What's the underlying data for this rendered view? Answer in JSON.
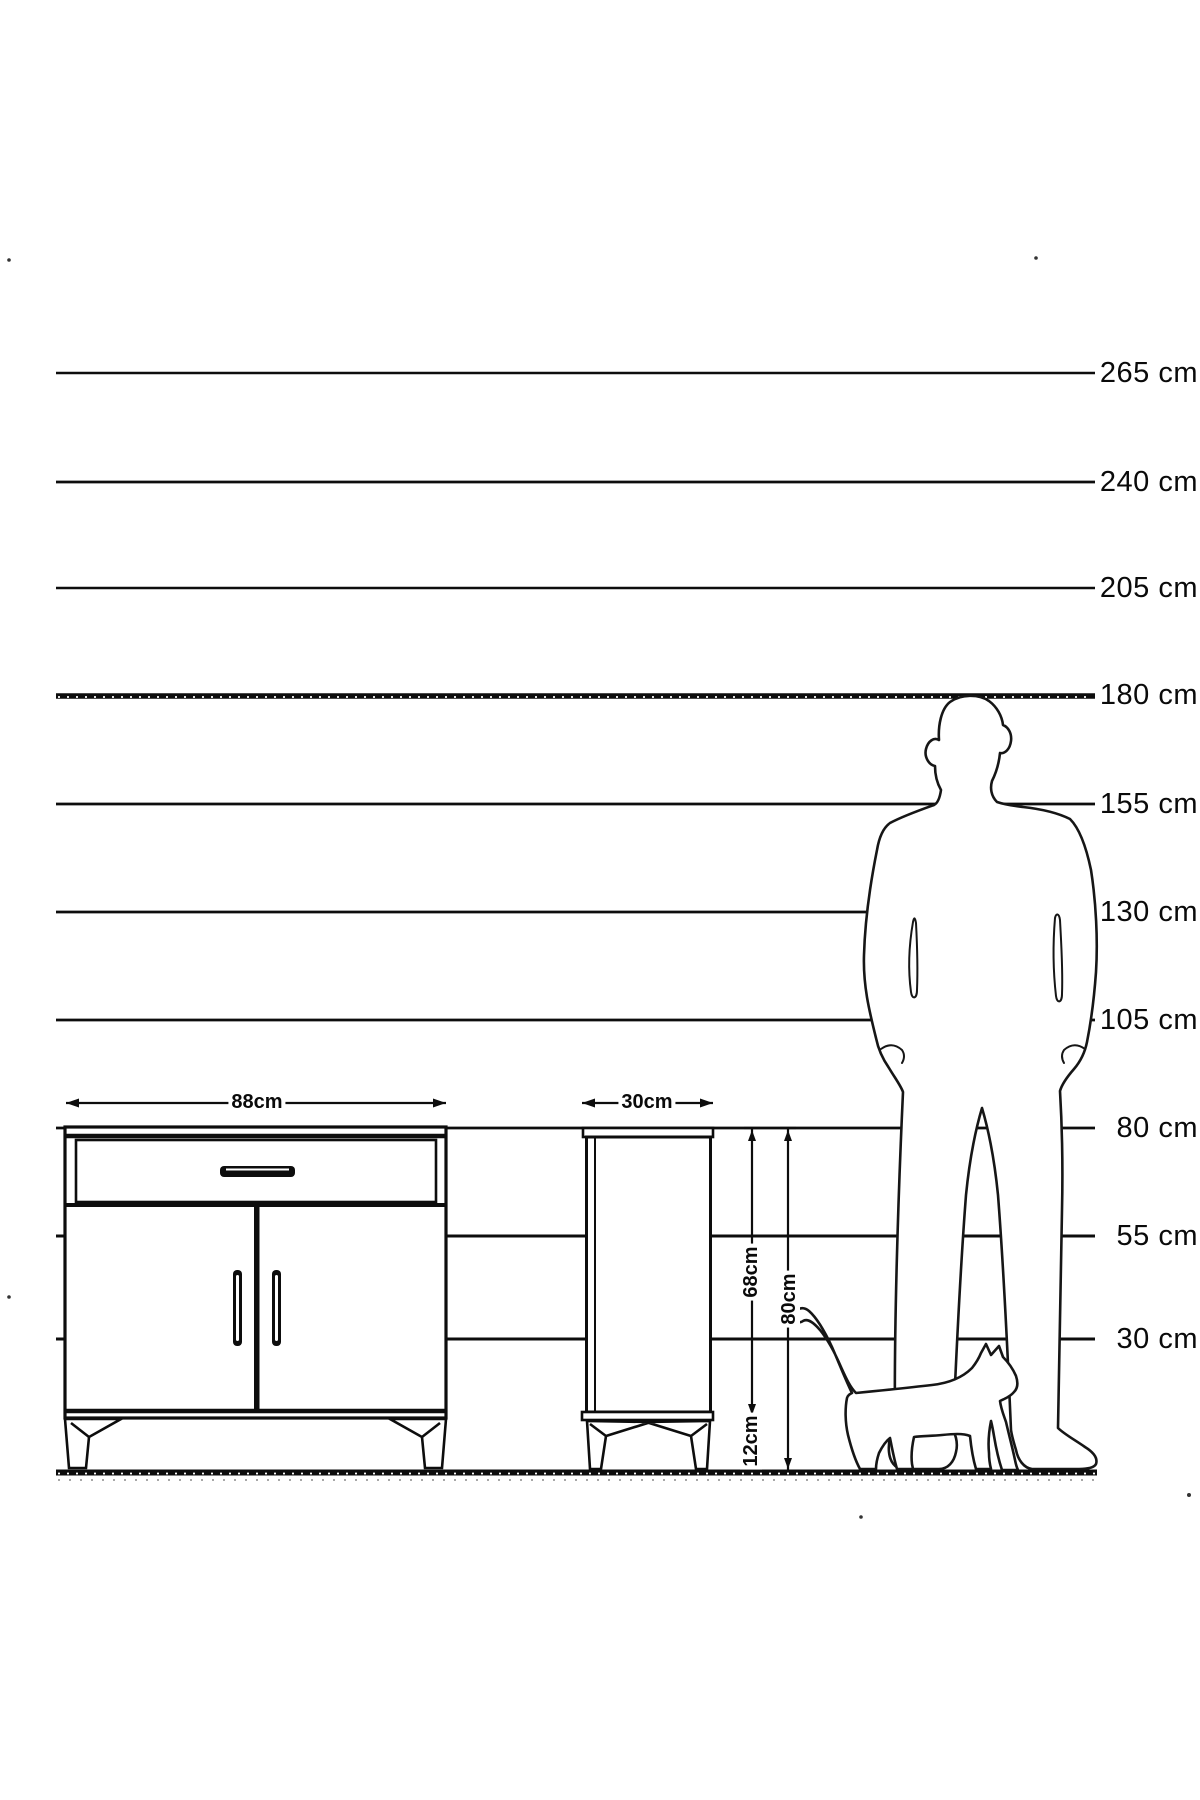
{
  "page": {
    "type": "furniture dimension diagram",
    "background_color": "#ffffff",
    "ink_color": "#0d0d0d",
    "unit": "cm"
  },
  "height_scale": {
    "unit": "cm",
    "labels": [
      "265 cm",
      "240 cm",
      "205 cm",
      "180 cm",
      "155 cm",
      "130 cm",
      "105 cm",
      "80 cm",
      "55 cm",
      "30 cm"
    ]
  },
  "dimensions": {
    "sideboard_width": "88cm",
    "cabinet_depth": "30cm",
    "carcass_height": "68cm",
    "overall_height": "80cm",
    "leg_height": "12cm"
  },
  "figures": {
    "man": "standing-man-silhouette",
    "cat": "walking-cat-silhouette"
  }
}
